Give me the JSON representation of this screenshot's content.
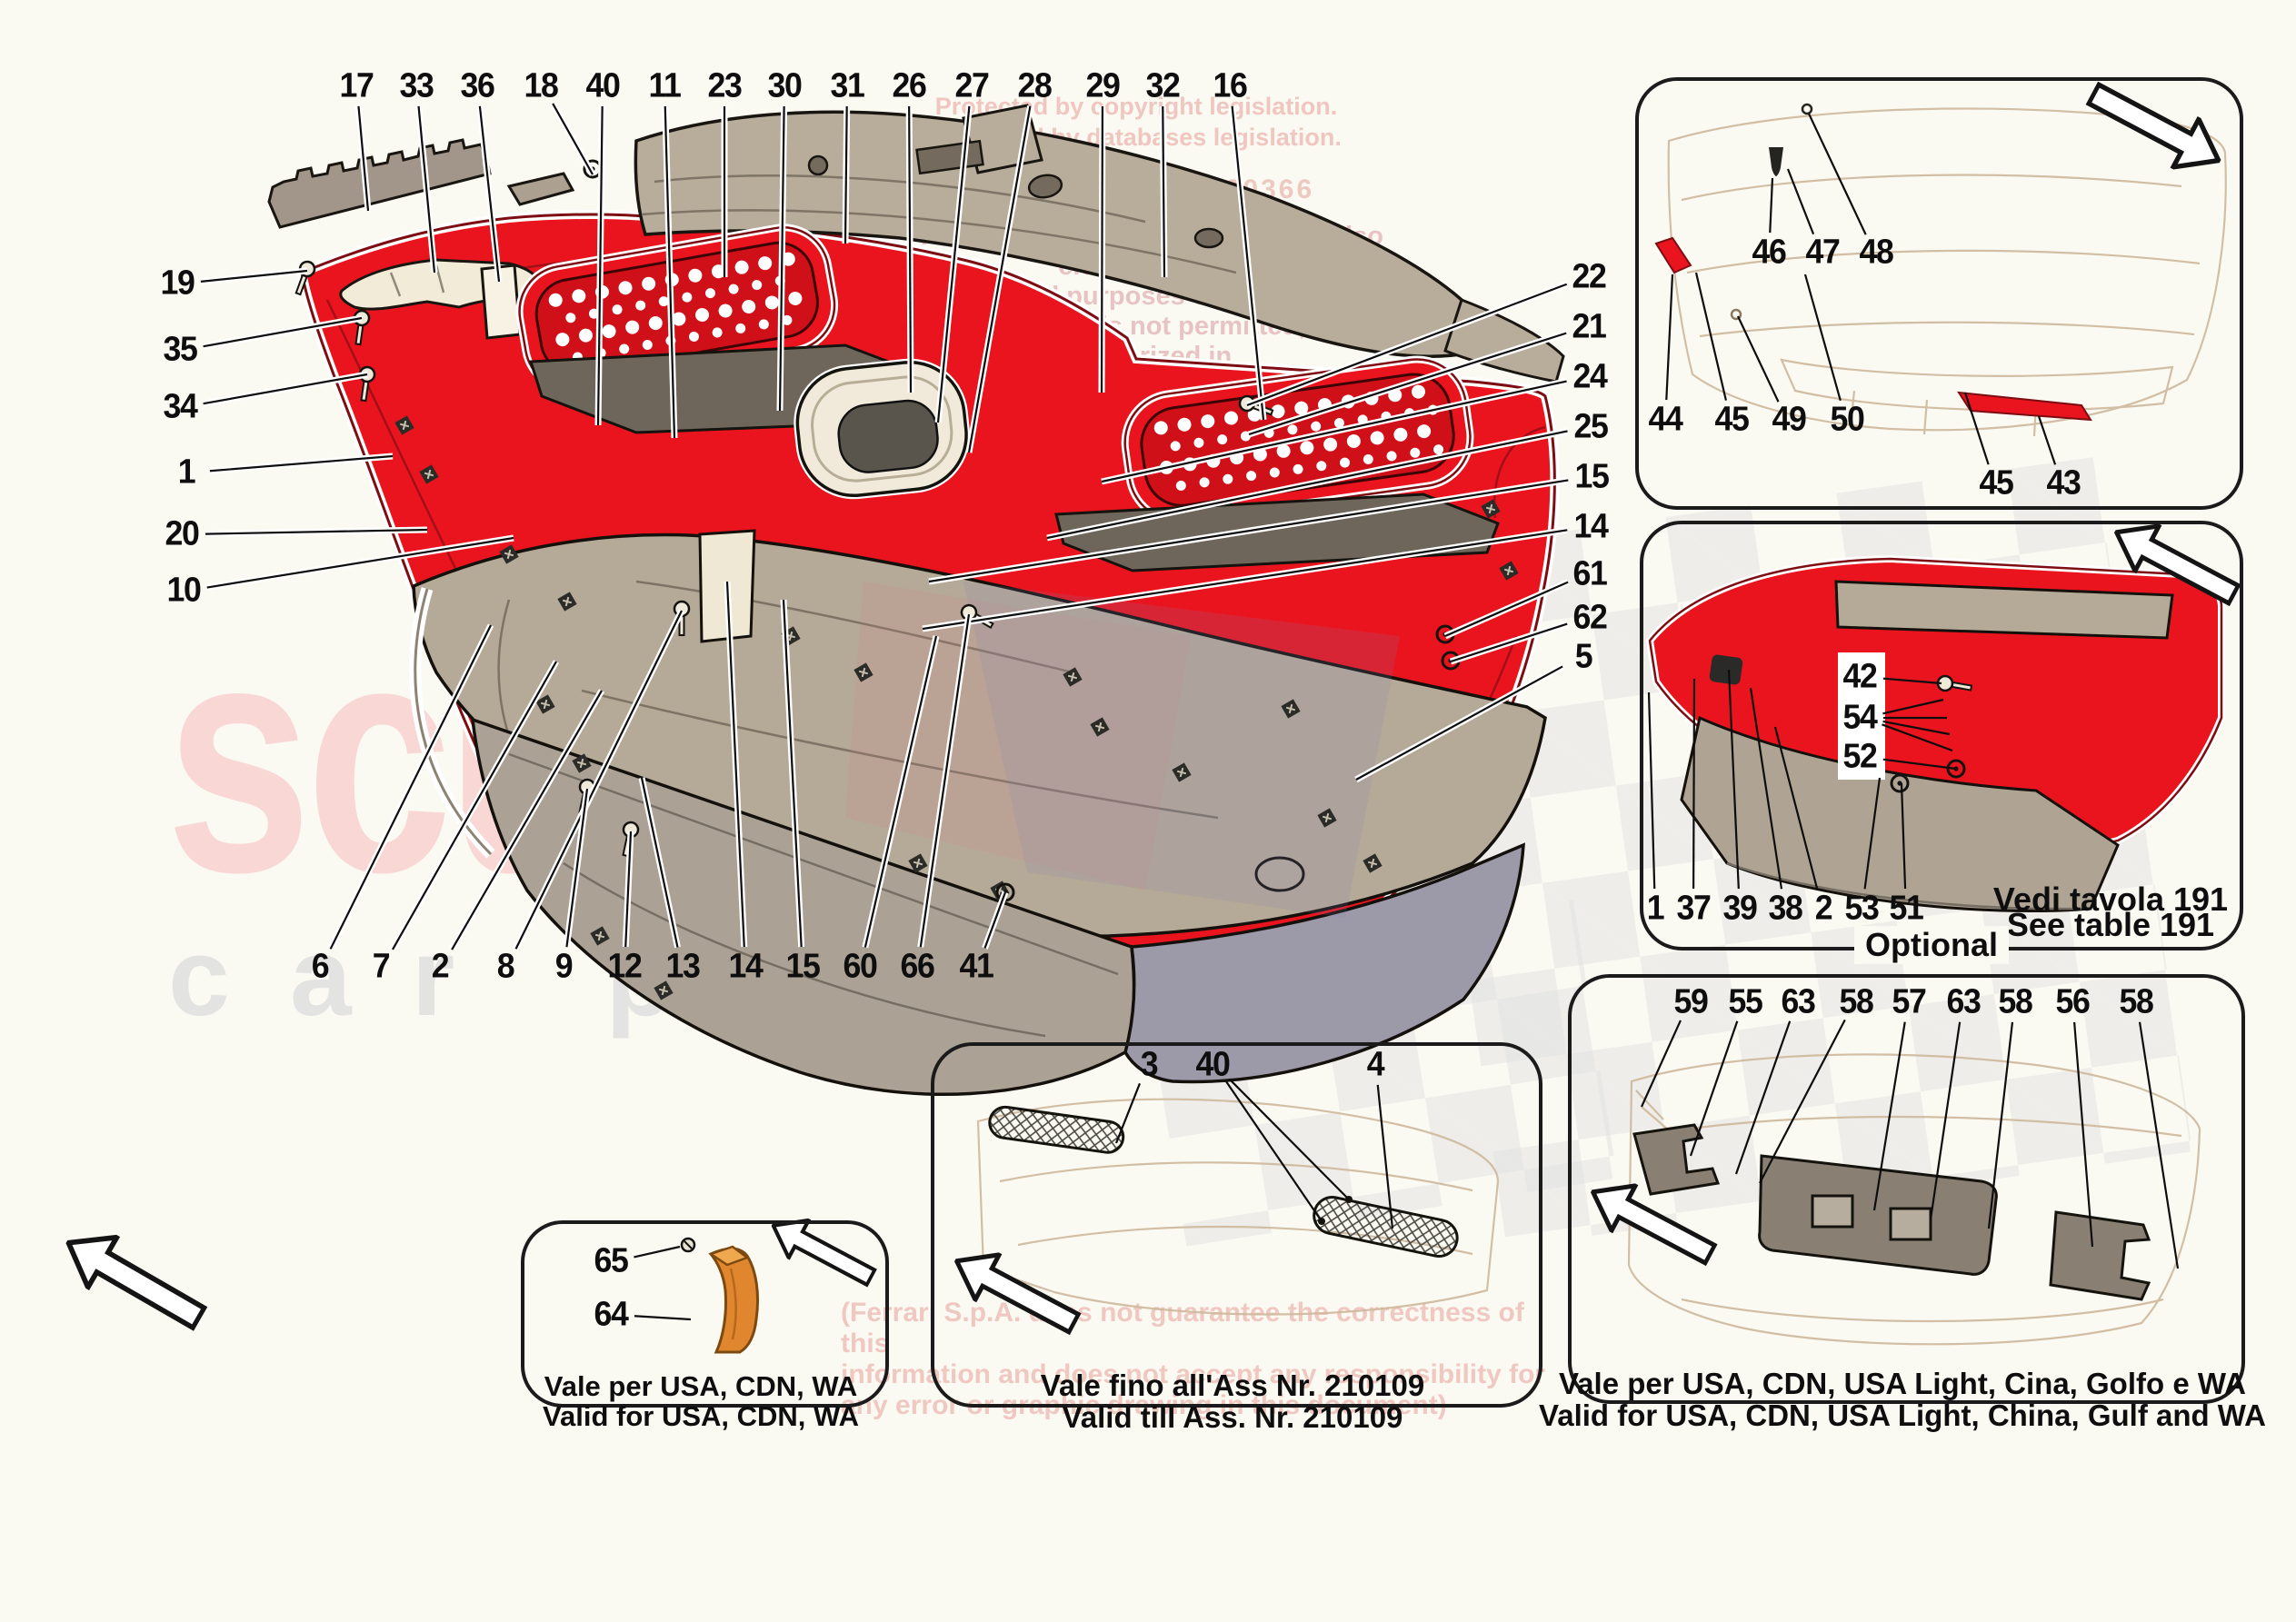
{
  "watermarks": {
    "brand_word": "scuderia",
    "brand_word2": "car parts",
    "copyright_lines": "Protected by copyright legislation.\nProtected by databases legislation.",
    "code_line": "RMX U0 50360366",
    "reproduction_lines": "The reproduction in any form(s) (also electronic), for\nnon commercial purposes of this document, in\npart or entirely, is not permitted, unless authorized in\nwriting by Ferrari S.p.A.",
    "disclaimer_lines": "(Ferrari S.p.A. does not guarantee the correctness of this\ninformation and does not accept any responsibility for\nany error or graphic drawing in this document)"
  },
  "main_diagram": {
    "callouts_top": [
      "17",
      "33",
      "36",
      "18",
      "40",
      "11",
      "23",
      "30",
      "31",
      "26",
      "27",
      "28",
      "29",
      "32",
      "16"
    ],
    "callouts_left": [
      "19",
      "35",
      "34",
      "1",
      "20",
      "10"
    ],
    "callouts_right": [
      "22",
      "21",
      "24",
      "25",
      "15",
      "14",
      "61",
      "62",
      "5"
    ],
    "callouts_bottom": [
      "6",
      "7",
      "2",
      "8",
      "9",
      "12",
      "13",
      "14",
      "15",
      "60",
      "66",
      "41"
    ]
  },
  "box_rear_view": {
    "callouts_upper": [
      "46",
      "47",
      "48"
    ],
    "callouts_mid": [
      "44",
      "45",
      "49",
      "50"
    ],
    "callouts_lower": [
      "45",
      "43"
    ]
  },
  "box_optional": {
    "tag": "Optional",
    "callouts_panel": [
      "42",
      "54",
      "52"
    ],
    "callouts_bottom": [
      "1",
      "37",
      "39",
      "38",
      "2",
      "53",
      "51"
    ],
    "note_line1": "Vedi tavola 191",
    "note_line2": "See table 191"
  },
  "box_usa_small": {
    "callouts": [
      "65",
      "64"
    ],
    "caption_line1": "Vale per USA, CDN, WA",
    "caption_line2": "Valid for USA, CDN, WA"
  },
  "box_assembly": {
    "callouts": [
      "3",
      "40",
      "4"
    ],
    "caption_line1": "Vale fino all'Ass Nr. 210109",
    "caption_line2": "Valid till Ass. Nr. 210109"
  },
  "box_usa_large": {
    "callouts": [
      "59",
      "55",
      "63",
      "58",
      "57",
      "63",
      "58",
      "56",
      "58"
    ],
    "caption_line1": "Vale per USA, CDN, USA Light, Cina, Golfo e WA",
    "caption_line2": "Valid for USA, CDN, USA Light, China, Gulf and WA"
  }
}
